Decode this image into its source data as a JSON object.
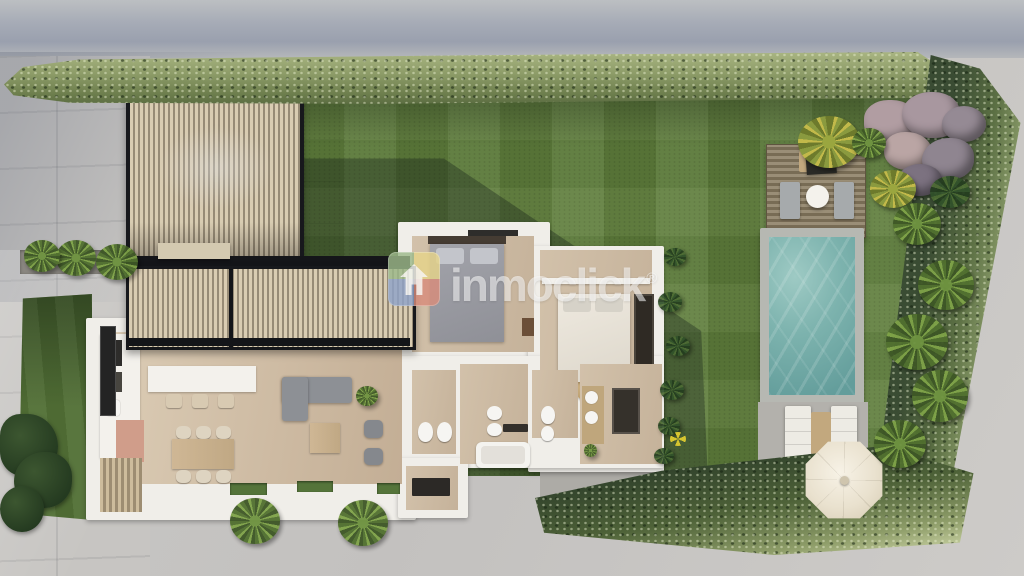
{
  "image": {
    "type": "architectural-render",
    "view": "top-down 3D render of a villa lot with garden, carport and pool"
  },
  "watermark": {
    "text": "inmoclick",
    "mark": "®",
    "text_color": "rgba(255,255,255,0.55)",
    "logo_colors": {
      "top_left": "#9db98a",
      "top_right": "#e6d48a",
      "bottom_right": "#d88d7c",
      "bottom_left": "#8fa3c8",
      "house_glyph": "#ffffff"
    }
  },
  "palette": {
    "pavement": "#c7c5c2",
    "street_shadow": "#9aa0ae",
    "lawn": "#5f7e3c",
    "hedge_light": "#a9b582",
    "hedge_dark": "#3a4c33",
    "pool_water": "#7db3ae",
    "pool_deck_wood": "#8f8472",
    "house_walls": "#f0eee9",
    "wood_floor": "#cdbaa2",
    "roof_slats": "#d9ccb2",
    "roof_frame": "#17181c",
    "umbrella": "#efe8d8",
    "rocks": "#a8979f",
    "sofa_gray": "#8d9095",
    "bed_gray": "#9c9da4",
    "bed_cream": "#eae6dc",
    "round_rug": "#c9ad7e"
  }
}
